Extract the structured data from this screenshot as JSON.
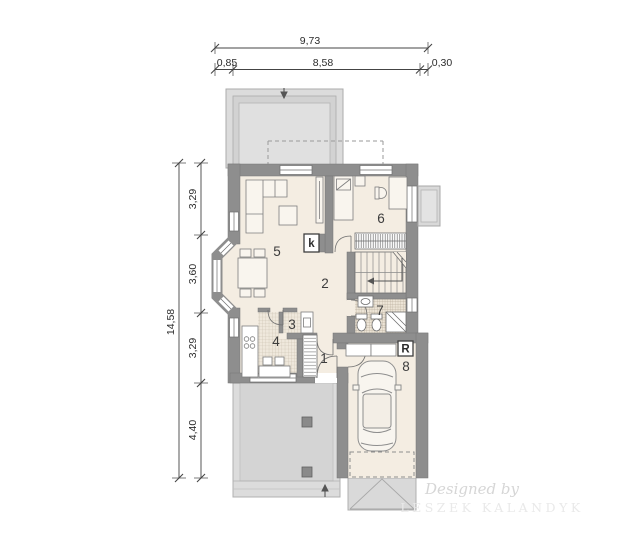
{
  "dimensions": {
    "top": {
      "total": "9,73",
      "segments": [
        "0,85",
        "8,58",
        "0,30"
      ]
    },
    "left": {
      "total": "14,58",
      "segments": [
        "3,29",
        "3,60",
        "3,29",
        "4,40"
      ]
    }
  },
  "room_labels": {
    "hall": "1",
    "living_room": "2",
    "pantry": "3",
    "kitchen": "4",
    "day_zone": "5",
    "bedroom": "6",
    "bathroom": "7",
    "garage": "8"
  },
  "markers": {
    "fireplace": "k",
    "boiler": "R"
  },
  "watermark": {
    "line1": "Designed by",
    "line2": "LESZEK KALANDYK"
  },
  "colors": {
    "wall": "#8e8e8e",
    "floor": "#f4ede2",
    "terrace": "#dcdcdc",
    "hatch_bg": "#efe8dc",
    "outline": "#6a6a6a",
    "dim_text": "#2c2c2c"
  }
}
